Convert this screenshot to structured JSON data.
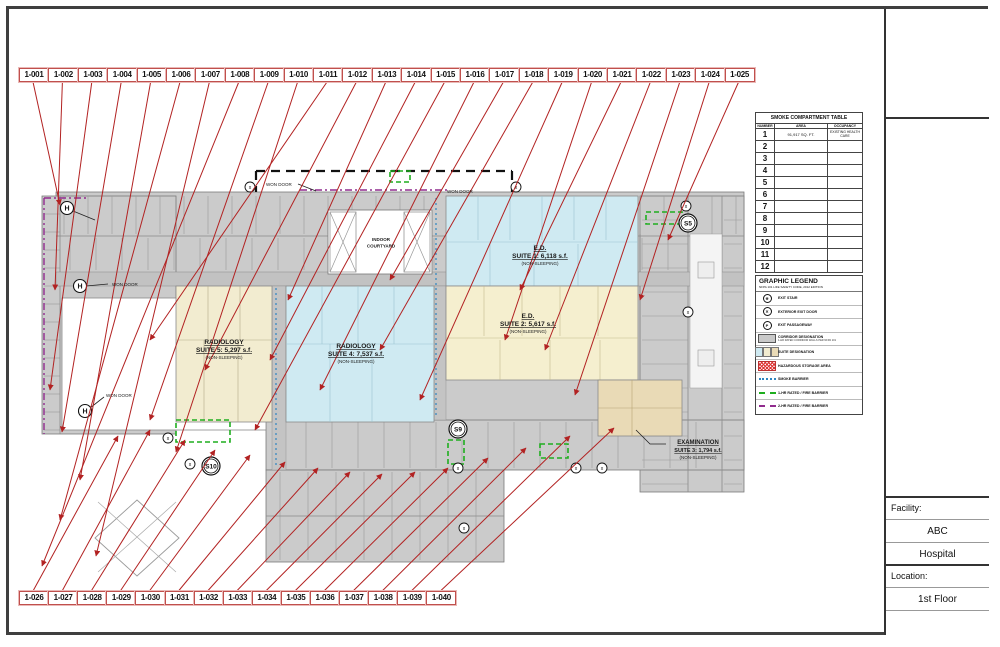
{
  "sheet": {
    "facility_label": "Facility:",
    "facility_line1": "ABC",
    "facility_line2": "Hospital",
    "location_label": "Location:",
    "location_value": "1st Floor"
  },
  "callouts": {
    "top": [
      "1-001",
      "1-002",
      "1-003",
      "1-004",
      "1-005",
      "1-006",
      "1-007",
      "1-008",
      "1-009",
      "1-010",
      "1-011",
      "1-012",
      "1-013",
      "1-014",
      "1-015",
      "1-016",
      "1-017",
      "1-018",
      "1-019",
      "1-020",
      "1-021",
      "1-022",
      "1-023",
      "1-024",
      "1-025"
    ],
    "bottom": [
      "1-026",
      "1-027",
      "1-028",
      "1-029",
      "1-030",
      "1-031",
      "1-032",
      "1-033",
      "1-034",
      "1-035",
      "1-036",
      "1-037",
      "1-038",
      "1-039",
      "1-040"
    ]
  },
  "smoke_table": {
    "title": "SMOKE COMPARTMENT TABLE",
    "headers": [
      "NUMBER",
      "AREA",
      "OCCUPANCY"
    ],
    "rows": [
      {
        "number": "1",
        "area": "91,917 SQ. FT.",
        "occupancy": "EXISTING HEALTH CARE"
      },
      {
        "number": "2",
        "area": "",
        "occupancy": ""
      },
      {
        "number": "3",
        "area": "",
        "occupancy": ""
      },
      {
        "number": "4",
        "area": "",
        "occupancy": ""
      },
      {
        "number": "5",
        "area": "",
        "occupancy": ""
      },
      {
        "number": "6",
        "area": "",
        "occupancy": ""
      },
      {
        "number": "7",
        "area": "",
        "occupancy": ""
      },
      {
        "number": "8",
        "area": "",
        "occupancy": ""
      },
      {
        "number": "9",
        "area": "",
        "occupancy": ""
      },
      {
        "number": "10",
        "area": "",
        "occupancy": ""
      },
      {
        "number": "11",
        "area": "",
        "occupancy": ""
      },
      {
        "number": "12",
        "area": "",
        "occupancy": ""
      }
    ]
  },
  "legend": {
    "title": "GRAPHIC LEGEND",
    "subtitle": "NFPA 101 LIFE SAFETY CODE, 2012 EDITION",
    "items": [
      {
        "icon": "exit-stair-icon",
        "glyph": "✳",
        "label": "EXIT STAIR"
      },
      {
        "icon": "exterior-exit-door-icon",
        "glyph": "✕",
        "label": "EXTERIOR EXIT DOOR"
      },
      {
        "icon": "exit-passageway-icon",
        "glyph": "P",
        "label": "EXIT PASSAGEWAY"
      },
      {
        "icon": "corridor-swatch",
        "label": "CORRIDOR DESIGNATION",
        "note": "1-HR RATED CORRIDOR WALLS PER NFPA 101"
      },
      {
        "icon": "suite-swatch",
        "label": "SUITE DESIGNATION"
      },
      {
        "icon": "hazardous-swatch",
        "label": "HAZARDOUS STORAGE AREA"
      },
      {
        "icon": "smoke-barrier-line",
        "label": "SMOKE BARRIER"
      },
      {
        "icon": "fire-barrier-1hr-line",
        "label": "1-HR RATED / FIRE BARRIER"
      },
      {
        "icon": "fire-barrier-2hr-line",
        "label": "2-HR RATED / FIRE BARRIER"
      }
    ]
  },
  "plan": {
    "labels": {
      "won_door": "WON DOOR",
      "courtyard_line1": "INDOOR",
      "courtyard_line2": "COURTYARD",
      "suite1_line1": "E.D.",
      "suite1_line2": "SUITE 1: 6,118 s.f.",
      "suite1_line3": "(NON-SLEEPING)",
      "suite2_line1": "E.D.",
      "suite2_line2": "SUITE 2: 5,617 s.f.",
      "suite2_line3": "(NON-SLEEPING)",
      "suite3_line1": "EXAMINATION",
      "suite3_line2": "SUITE 3: 1,794 s.f.",
      "suite3_line3": "(NON-SLEEPING)",
      "suite4_line1": "RADIOLOGY",
      "suite4_line2": "SUITE 4: 7,537 s.f.",
      "suite4_line3": "(NON-SLEEPING)",
      "suite5_line1": "RADIOLOGY",
      "suite5_line2": "SUITE 5: 5,297 s.f.",
      "suite5_line3": "(NON-SLEEPING)"
    },
    "markers": {
      "s5": "S5",
      "s9": "S9",
      "s10": "S10",
      "h": "H",
      "x_mark": "x"
    }
  },
  "colors": {
    "callout_red": "#b22222",
    "barrier_green": "#1fae1f",
    "barrier_purple": "#912b8e",
    "smoke_blue": "#2e86c1",
    "suite_cyan": "#cfeaf2",
    "suite_cream": "#f2ecd0",
    "suite_yellow": "#f5efcf",
    "suite_tan": "#e9dab6",
    "corridor_gray": "#c9c9c9"
  }
}
